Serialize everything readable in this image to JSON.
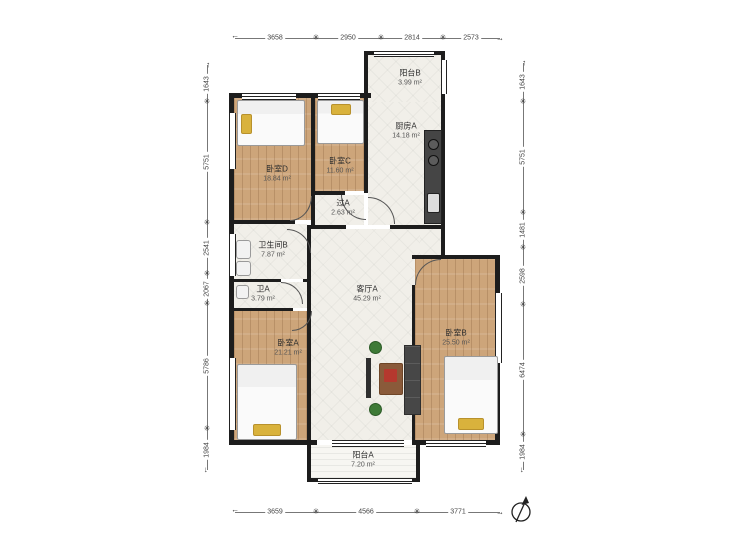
{
  "rooms": {
    "balcony_b": {
      "name": "阳台B",
      "area": "3.99 m²"
    },
    "kitchen_a": {
      "name": "厨房A",
      "area": "14.18 m²"
    },
    "bedroom_d": {
      "name": "卧室D",
      "area": "18.84 m²"
    },
    "bedroom_c": {
      "name": "卧室C",
      "area": "11.60 m²"
    },
    "hall_a": {
      "name": "过A",
      "area": "2.63 m²"
    },
    "bathroom_b": {
      "name": "卫生间B",
      "area": "7.87 m²"
    },
    "bathroom_a": {
      "name": "卫A",
      "area": "3.79 m²"
    },
    "living_a": {
      "name": "客厅A",
      "area": "45.29 m²"
    },
    "bedroom_a": {
      "name": "卧室A",
      "area": "21.21 m²"
    },
    "bedroom_b": {
      "name": "卧室B",
      "area": "25.50 m²"
    },
    "balcony_a": {
      "name": "阳台A",
      "area": "7.20 m²"
    }
  },
  "dimensions": {
    "top": [
      "3658",
      "2950",
      "2814",
      "2573"
    ],
    "bottom": [
      "3659",
      "4566",
      "3771"
    ],
    "left": [
      "1643",
      "5751",
      "2541",
      "2067",
      "5786",
      "1984"
    ],
    "right": [
      "1643",
      "5751",
      "1481",
      "2598",
      "6474",
      "1984"
    ]
  },
  "glyphs": {
    "dim_tick": "✳",
    "dim_arrow": "→"
  },
  "colors": {
    "wall": "#1d1d1d",
    "wood_floor": "#cda57a",
    "tile_floor": "#f1efe9",
    "pillow_accent": "#d9b23c",
    "dimension_text": "#444444"
  }
}
